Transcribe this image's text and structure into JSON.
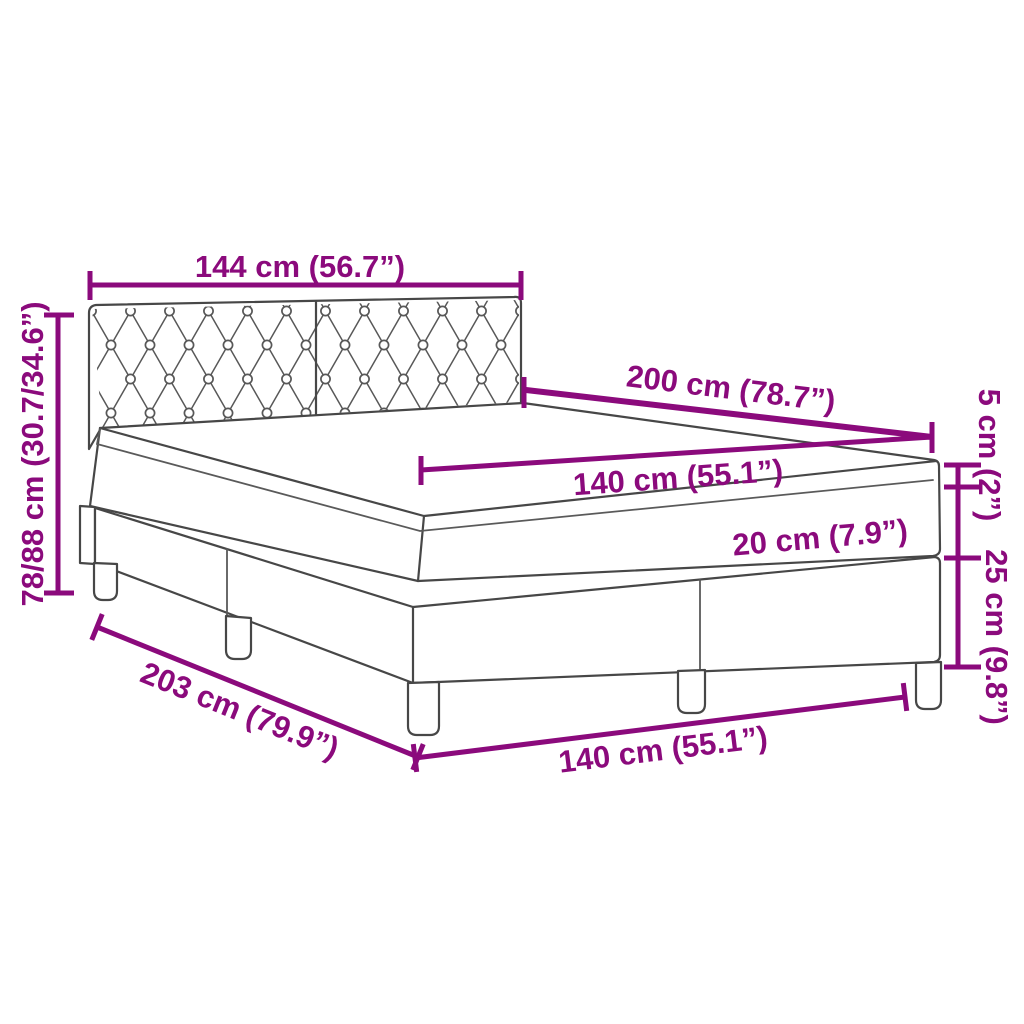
{
  "diagram": {
    "type": "product-dimension-diagram",
    "subject": "box-spring-bed-with-tufted-headboard",
    "colors": {
      "dimension_accent": "#8B0A7C",
      "line_art": "#474747",
      "background": "#FFFFFF"
    },
    "labels": {
      "headboard_width": "144 cm (56.7”)",
      "headboard_height": "78/88 cm (30.7/34.6”)",
      "bed_length": "200 cm (78.7”)",
      "mattress_top_width": "140 cm (55.1”)",
      "topper_thickness": "5 cm (2”)",
      "mattress_thickness": "20 cm (7.9”)",
      "base_height": "25 cm (9.8”)",
      "total_length": "203 cm (79.9”)",
      "bed_width": "140 cm (55.1”)"
    }
  }
}
